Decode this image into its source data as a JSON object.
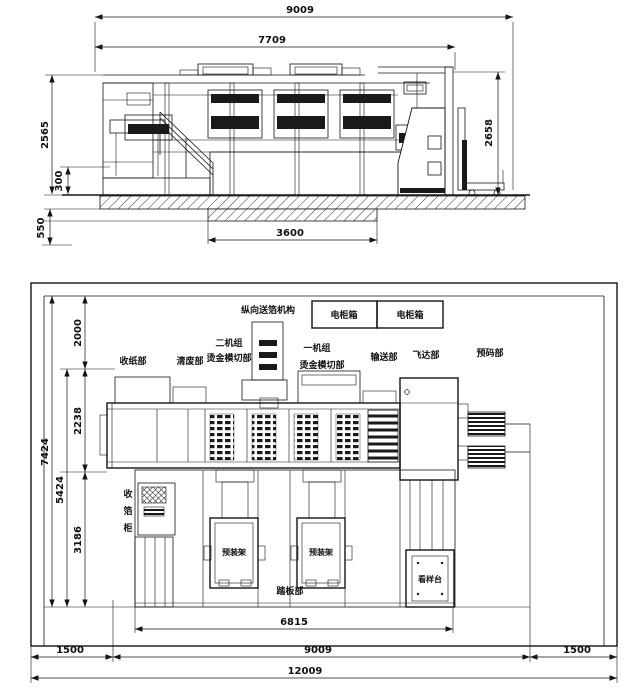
{
  "elevation": {
    "dims": {
      "overall_width": "9009",
      "frame_width": "7709",
      "left_height": "2565",
      "step_height": "300",
      "pit_depth": "550",
      "pit_width": "3600",
      "right_height": "2658"
    }
  },
  "plan": {
    "dims": {
      "room_depth": "7424",
      "machine_zone_depth": "5424",
      "rear_clearance": "2000",
      "machine_body_depth": "2238",
      "front_zone_depth": "3186",
      "platform_width": "6815",
      "left_clearance": "1500",
      "machine_length": "9009",
      "right_clearance": "1500",
      "room_length": "12009"
    },
    "labels": {
      "foil_feed_mechanism": "纵向送箔机构",
      "electric_cabinet_left": "电柜箱",
      "electric_cabinet_right": "电柜箱",
      "delivery_section": "收纸部",
      "stripping_section": "清废部",
      "unit2_title": "二机组",
      "unit2_subtitle": "烫金模切部",
      "unit1_title": "一机组",
      "unit1_subtitle": "烫金模切部",
      "transport_section": "输送部",
      "feeder_section": "飞达部",
      "prestack_section": "预码部",
      "foil_cabinet_chars": [
        "收",
        "箔",
        "柜"
      ],
      "preload_rack_left": "预装架",
      "preload_rack_right": "预装架",
      "footboard_section": "踏板部",
      "sample_table": "看样台"
    }
  }
}
